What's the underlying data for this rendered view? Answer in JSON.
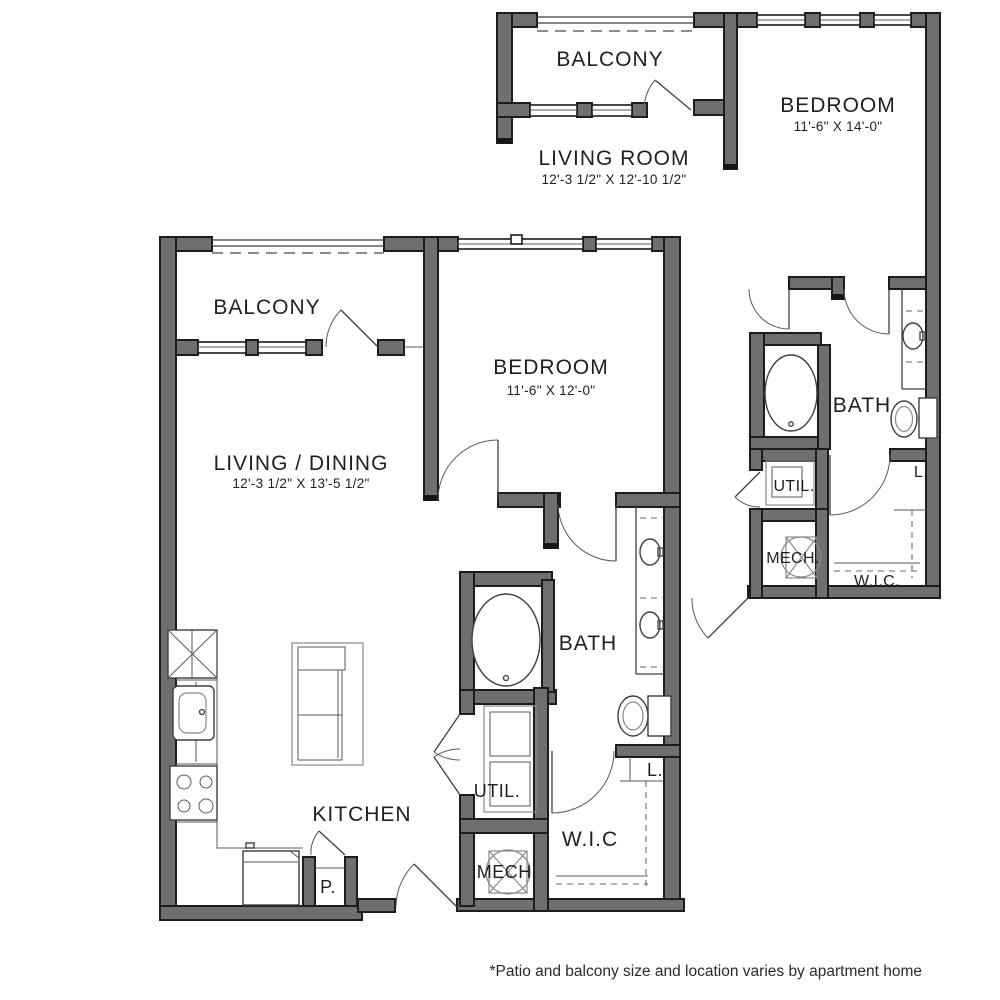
{
  "footnote": "*Patio and balcony size and location varies by apartment home",
  "colors": {
    "wall_fill": "#6f6f6f",
    "wall_outline": "#1c1c1c",
    "line": "#3f3f3f",
    "text": "#1f1f1f"
  },
  "plan_left": {
    "balcony_label": "BALCONY",
    "living_label": "LIVING / DINING",
    "living_dims": "12'-3 1/2\" X 13'-5 1/2\"",
    "bedroom_label": "BEDROOM",
    "bedroom_dims": "11'-6\" X 12'-0\"",
    "bath_label": "BATH",
    "kitchen_label": "KITCHEN",
    "util_label": "UTIL.",
    "mech_label": "MECH.",
    "wic_label": "W.I.C",
    "pantry_label": "P.",
    "linen_label": "L."
  },
  "plan_right": {
    "balcony_label": "BALCONY",
    "living_label": "LIVING ROOM",
    "living_dims": "12'-3 1/2\" X 12'-10 1/2\"",
    "bedroom_label": "BEDROOM",
    "bedroom_dims": "11'-6\" X 14'-0\"",
    "bath_label": "BATH",
    "util_label": "UTIL.",
    "mech_label": "MECH.",
    "wic_label": "W.I.C.",
    "linen_label": "L."
  }
}
